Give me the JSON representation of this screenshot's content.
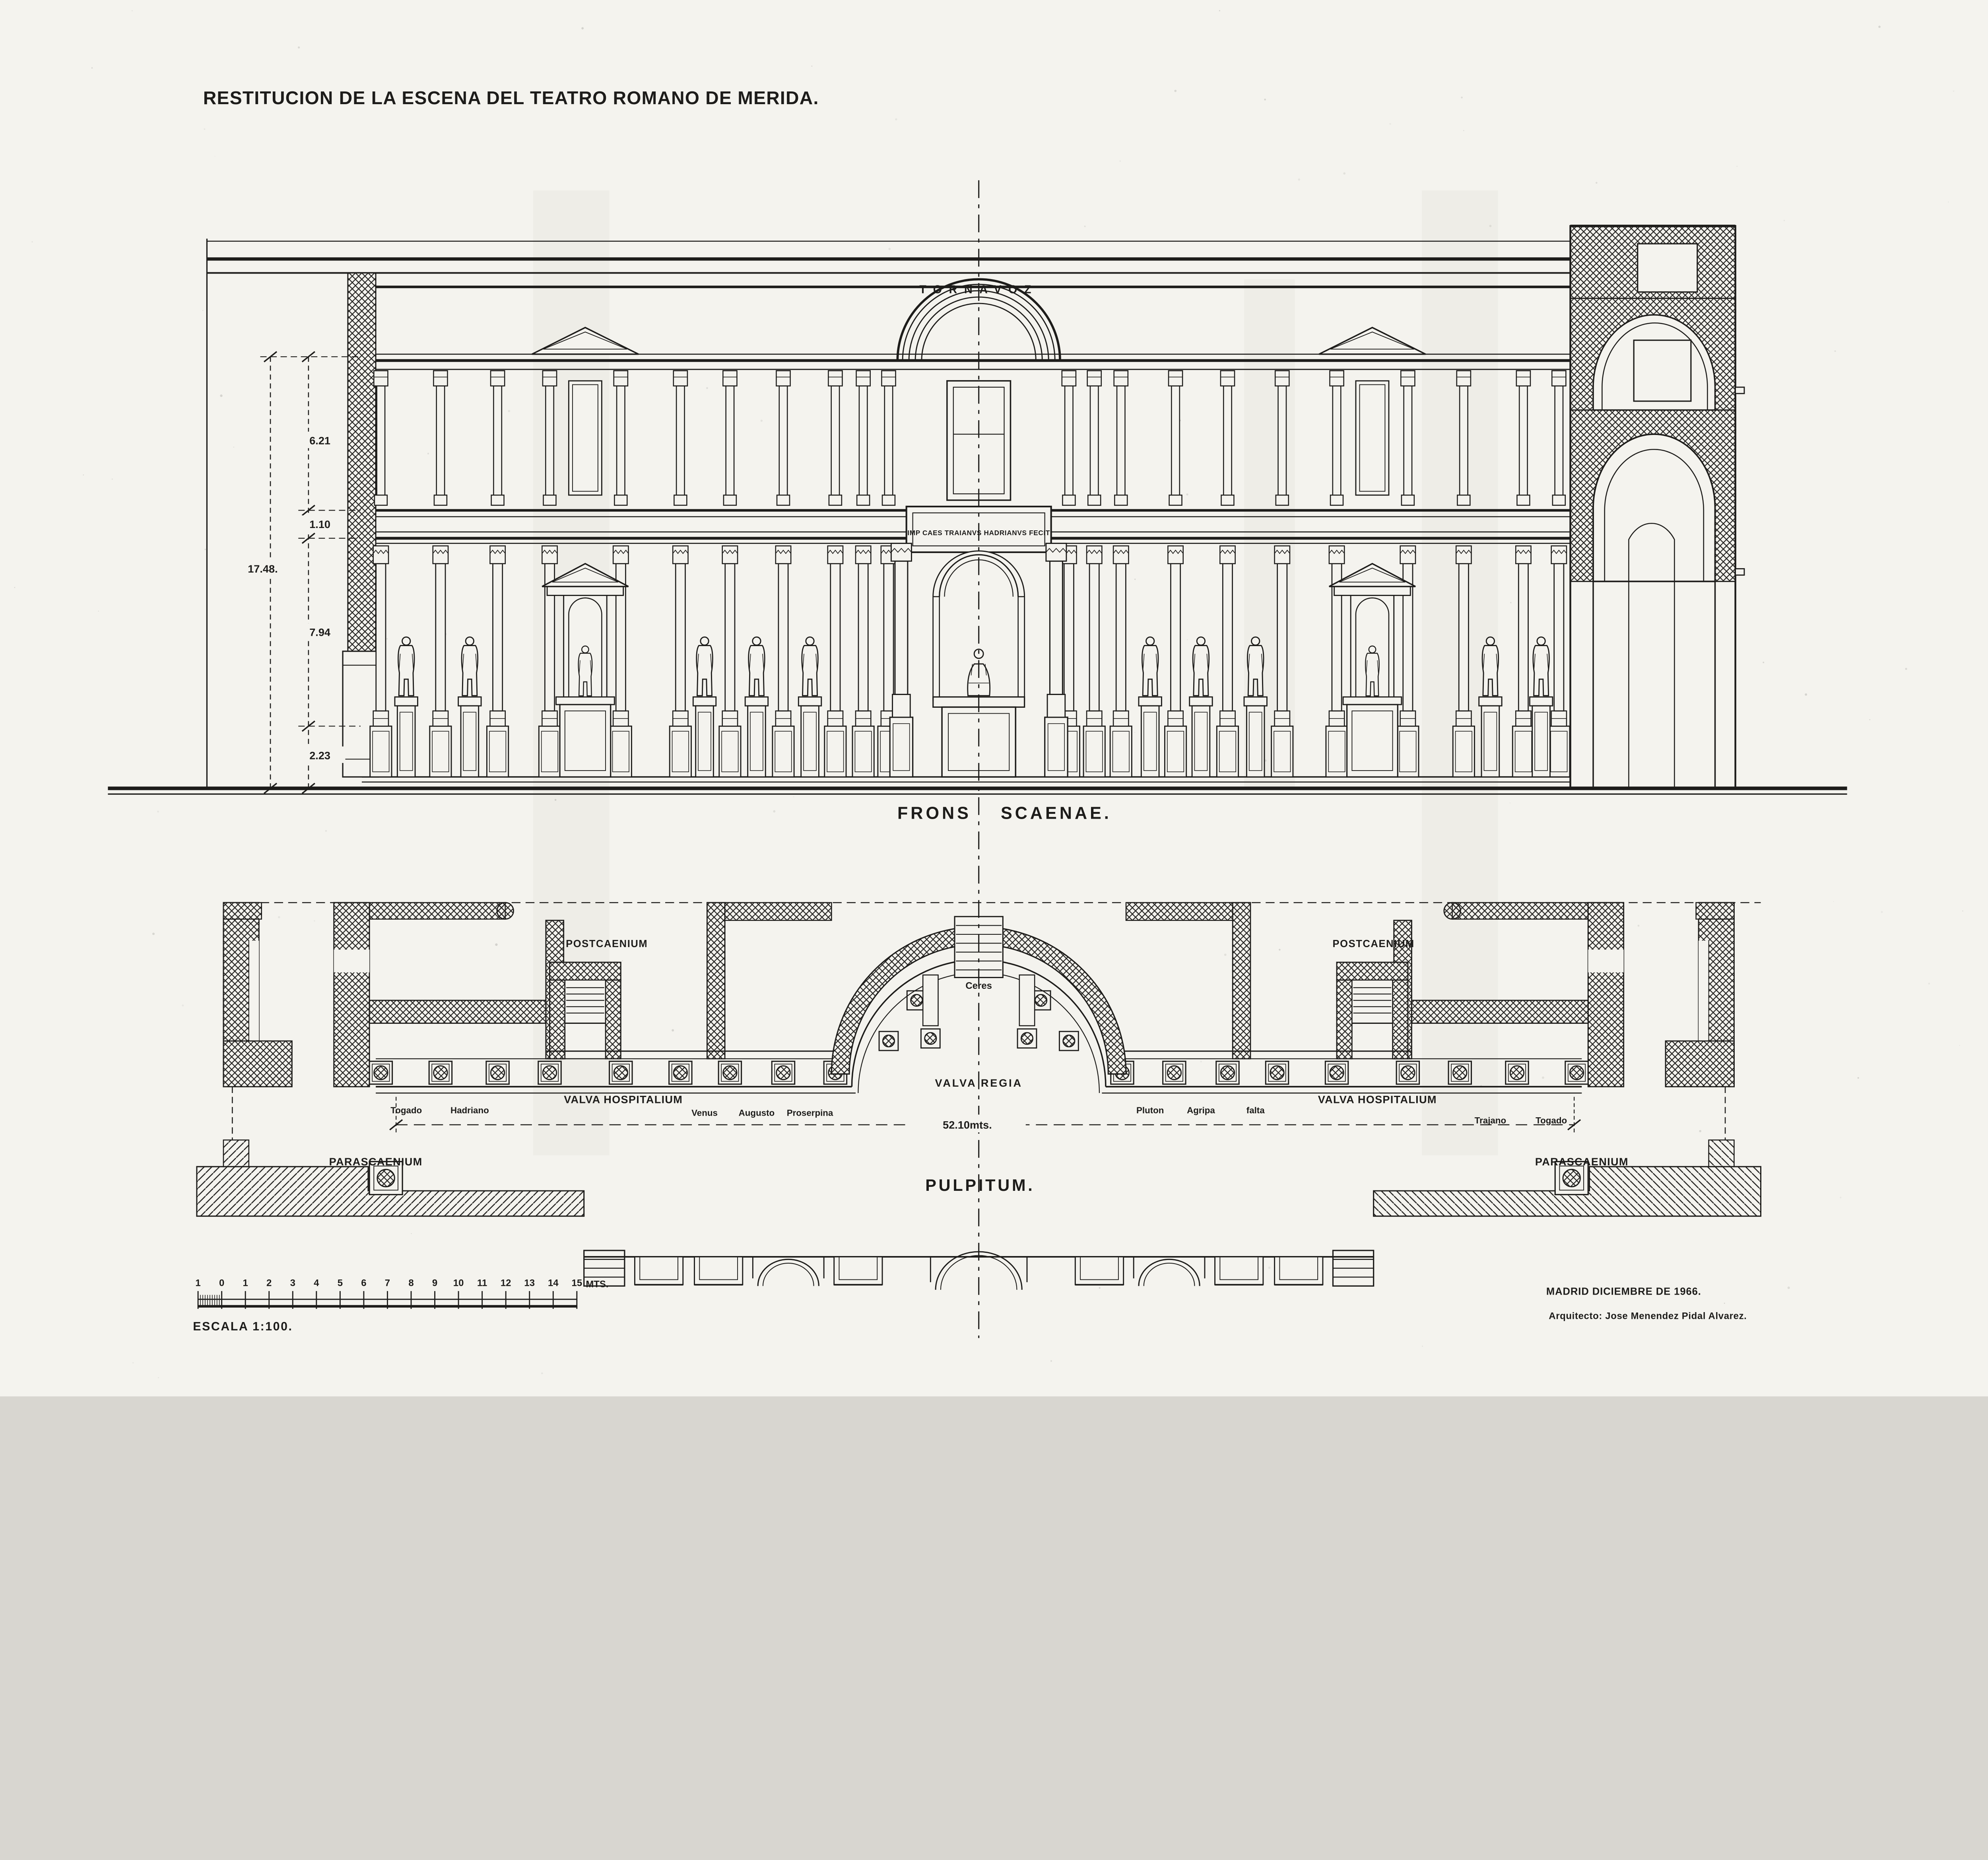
{
  "title": "RESTITUCION DE LA ESCENA DEL TEATRO ROMANO DE MERIDA.",
  "elevation": {
    "tornavoz": "TORNAVOZ",
    "inscription": "IMP CAES TRAIANVS HADRIANVS FECIT",
    "caption": {
      "word1": "FRONS",
      "word2": "SCAENAE."
    },
    "dims": {
      "upper": "6.21",
      "band": "1.10",
      "total": "17.48.",
      "column": "7.94",
      "podium": "2.23"
    }
  },
  "plan": {
    "caption": "PULPITUM.",
    "postcaenium": "POSTCAENIUM",
    "valva_hospitalium": "VALVA HOSPITALIUM",
    "valva_regia": "VALVA REGIA",
    "altar": "Ceres",
    "parascaenium": "PARASCAENIUM",
    "width": "52.10mts.",
    "statue_labels": [
      "Togado",
      "Hadriano",
      "Venus",
      "Augusto",
      "Proserpina",
      "Pluton",
      "Agripa",
      "falta",
      "Trajano",
      "Togado"
    ]
  },
  "scale_bar": {
    "tick_labels": [
      "1",
      "0",
      "1",
      "2",
      "3",
      "4",
      "5",
      "6",
      "7",
      "8",
      "9",
      "10",
      "11",
      "12",
      "13",
      "14",
      "15"
    ],
    "unit": "MTS.",
    "caption": "ESCALA 1:100."
  },
  "footer": {
    "line1": "MADRID DICIEMBRE DE 1966.",
    "line2": "Arquitecto: Jose Menendez Pidal Alvarez."
  },
  "colors": {
    "ink": "#1d1c1a",
    "paper": "#f4f3ee"
  }
}
